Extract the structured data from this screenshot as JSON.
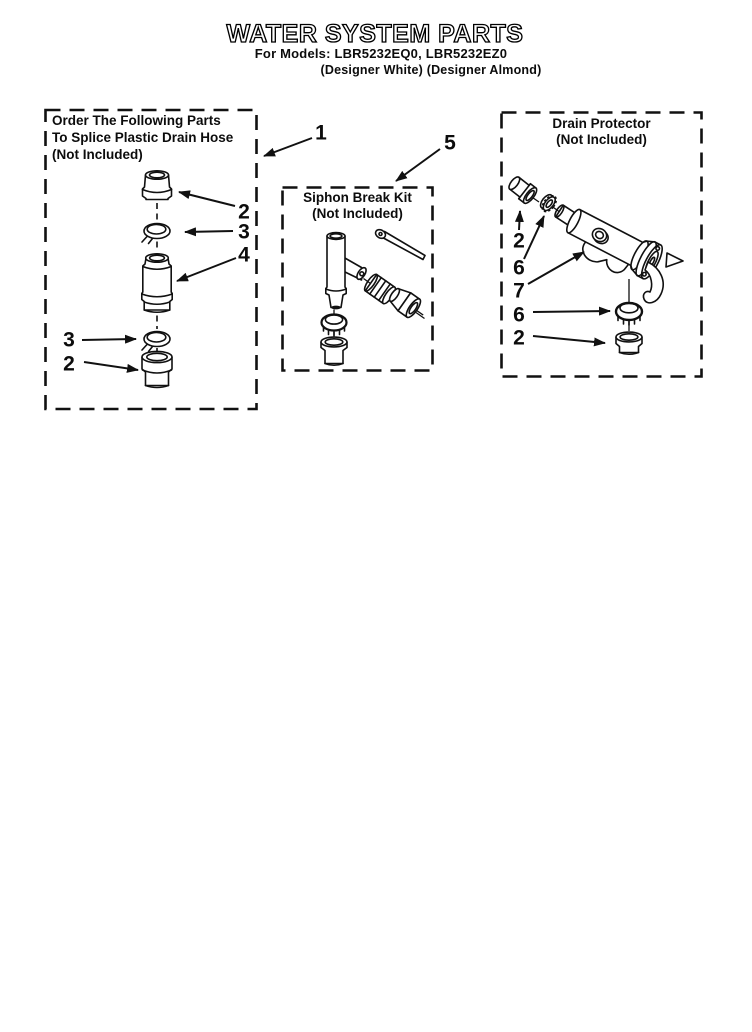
{
  "header": {
    "title": "WATER SYSTEM PARTS",
    "models_line": "For Models: LBR5232EQ0, LBR5232EZ0",
    "colors_line": "(Designer White) (Designer Almond)"
  },
  "boxes": {
    "splice_kit": {
      "title_lines": [
        "Order The Following Parts",
        "To Splice Plastic Drain Hose",
        "(Not Included)"
      ]
    },
    "siphon_kit": {
      "title_lines": [
        "Siphon Break Kit",
        "(Not Included)"
      ]
    },
    "drain_protector": {
      "title_lines": [
        "Drain Protector",
        "(Not Included)"
      ]
    }
  },
  "callouts": {
    "box_splice": "1",
    "box_siphon": "5",
    "splice_top_fitting": "2",
    "splice_top_clamp": "3",
    "splice_coupler": "4",
    "splice_bottom_clamp": "3",
    "splice_bottom_fitting": "2",
    "drain_inlet_fitting": "2",
    "drain_inlet_clamp": "6",
    "drain_valve_body": "7",
    "drain_outlet_clamp": "6",
    "drain_outlet_fitting": "2"
  },
  "colors": {
    "ink": "#111111",
    "paper": "#ffffff"
  }
}
